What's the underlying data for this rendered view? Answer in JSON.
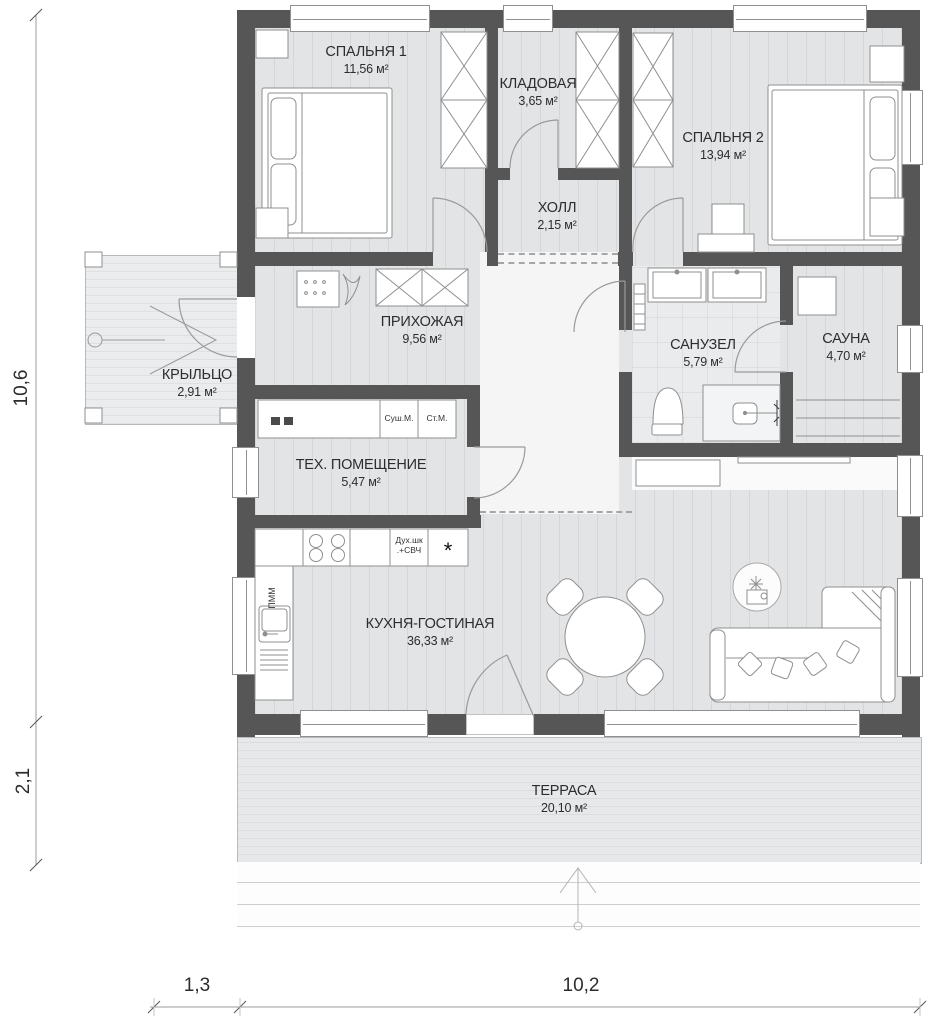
{
  "rooms": {
    "bedroom1": {
      "name": "СПАЛЬНЯ 1",
      "area": "11,56 м²"
    },
    "storage": {
      "name": "КЛАДОВАЯ",
      "area": "3,65 м²"
    },
    "bedroom2": {
      "name": "СПАЛЬНЯ 2",
      "area": "13,94 м²"
    },
    "hall": {
      "name": "ХОЛЛ",
      "area": "2,15 м²"
    },
    "porch": {
      "name": "КРЫЛЬЦО",
      "area": "2,91 м²"
    },
    "entry": {
      "name": "ПРИХОЖАЯ",
      "area": "9,56 м²"
    },
    "bathroom": {
      "name": "САНУЗЕЛ",
      "area": "5,79 м²"
    },
    "sauna": {
      "name": "САУНА",
      "area": "4,70 м²"
    },
    "tech": {
      "name": "ТЕХ. ПОМЕЩЕНИЕ",
      "area": "5,47 м²"
    },
    "kitchen": {
      "name": "КУХНЯ-ГОСТИНАЯ",
      "area": "36,33 м²"
    },
    "terrace": {
      "name": "ТЕРРАСА",
      "area": "20,10 м²"
    }
  },
  "appliances": {
    "dryer": "Суш.М.",
    "washer": "Ст.М.",
    "oven_line1": "Дух.шк",
    "oven_line2": ".+СВЧ",
    "dishwasher": "ПММ",
    "fridge_mark": "*"
  },
  "dimensions": {
    "height_total": "10,6",
    "terrace_depth": "2,1",
    "porch_width": "1,3",
    "width_total": "10,2"
  },
  "colors": {
    "wall": "#565656",
    "floor": "#e3e4e6"
  }
}
